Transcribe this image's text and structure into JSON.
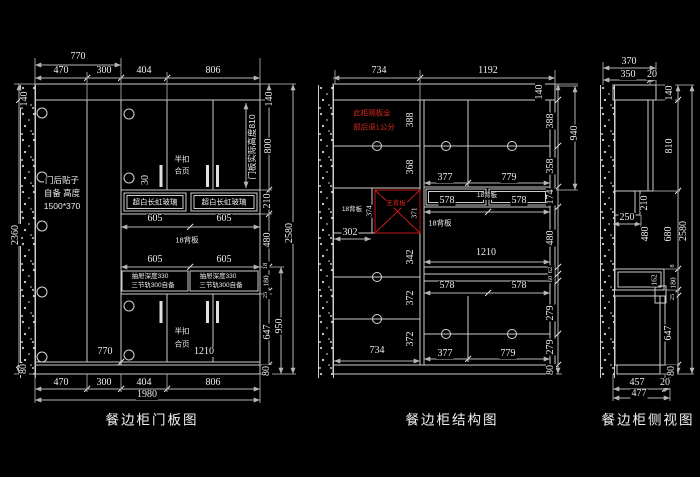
{
  "meta": {
    "bg": "#000000",
    "line": "#cdcdcd",
    "red": "#d8281c"
  },
  "lp": {
    "title": "餐边柜门板图",
    "d": {
      "v770": "770",
      "v470": "470",
      "v300": "300",
      "v404": "404",
      "v806": "806",
      "v140": "140",
      "v2360": "2360",
      "v80": "80",
      "v800": "800",
      "v210": "210",
      "v480": "480",
      "v18": "18",
      "v180": "180",
      "v25": "25",
      "v647": "647",
      "v950": "950",
      "v2580": "2580",
      "v605": "605",
      "v30": "30",
      "v1210": "1210",
      "v1980": "1980"
    },
    "n": {
      "door1": "门后贴子",
      "door2": "自备 高度",
      "door3": "1500*370",
      "hinge1": "半扣",
      "hinge2": "合页",
      "glass": "超白长虹玻璃",
      "back": "18背板",
      "drawer1": "抽屉深度330",
      "drawer2": "三节轨300自备",
      "height": "门板实际高度810"
    }
  },
  "mp": {
    "title": "餐边柜结构图",
    "d": {
      "v734": "734",
      "v1192": "1192",
      "v140": "140",
      "v388": "388",
      "v368": "368",
      "v374": "374",
      "v371": "371",
      "v342": "342",
      "v372": "372",
      "v302": "302",
      "v377": "377",
      "v779": "779",
      "v578": "578",
      "v174": "174",
      "v480": "480",
      "v62": "62",
      "v60": "60",
      "v279": "279",
      "v1210": "1210",
      "v80": "80",
      "v940": "940",
      "v358": "358"
    },
    "n": {
      "warn1": "此柜隔板全",
      "warn2": "部后退1公分",
      "noback": "无背板",
      "back": "18背板"
    }
  },
  "rp": {
    "title": "餐边柜侧视图",
    "d": {
      "v370": "370",
      "v350": "350",
      "v20": "20",
      "v140": "140",
      "v810": "810",
      "v210": "210",
      "v250": "250",
      "v480": "480",
      "v680": "680",
      "v2580": "2580",
      "v162": "162",
      "v8": "8",
      "v180": "180",
      "v25": "25",
      "v647": "647",
      "v80": "80",
      "v457": "457",
      "v477": "477"
    }
  }
}
